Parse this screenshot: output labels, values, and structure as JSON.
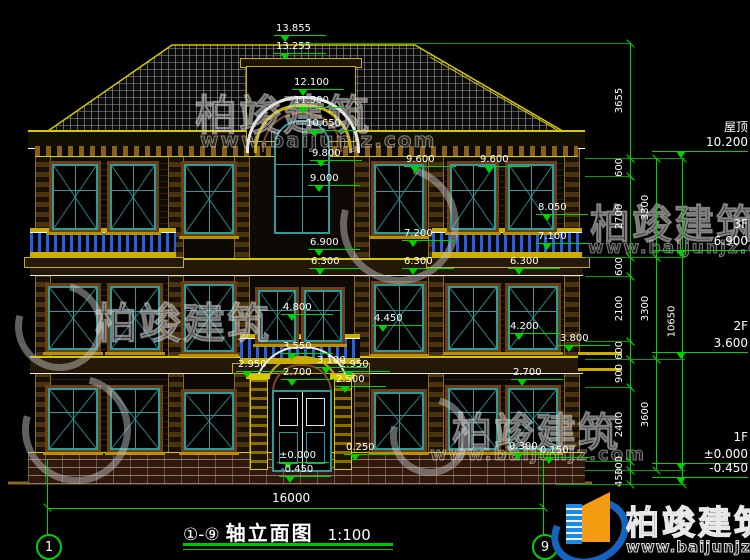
{
  "title_bar": {
    "axes": "①-⑨",
    "name": "轴立面图",
    "scale": "1:100"
  },
  "ground": {
    "total_dim": "16000",
    "axis1": "1",
    "axis9": "9"
  },
  "brand": {
    "name": "柏竣建筑",
    "url": "www.baijunjz.com"
  },
  "colors": {
    "dim_green": "#00d400",
    "trim_yellow": "#d8c800",
    "window_teal": "#2e9a9a",
    "baluster_blue": "#2b5fd9",
    "wall_brown": "#6b3f14",
    "brand_blue": "#1e88e5",
    "brand_orange": "#f39c12"
  },
  "floor_labels": [
    {
      "name": "屋顶",
      "elev": "10.200",
      "y": 158
    },
    {
      "name": "3F",
      "elev": "6.900",
      "y": 257
    },
    {
      "name": "2F",
      "elev": "3.600",
      "y": 359
    },
    {
      "name": "1F",
      "elev": "±0.000",
      "y": 470
    },
    {
      "name": "",
      "elev": "-0.450",
      "y": 484
    }
  ],
  "elevation_markers": [
    {
      "value": "13.855",
      "x": 276,
      "y": 43
    },
    {
      "value": "13.255",
      "x": 276,
      "y": 61
    },
    {
      "value": "12.100",
      "x": 294,
      "y": 97
    },
    {
      "value": "11.500",
      "x": 294,
      "y": 115
    },
    {
      "value": "10.650",
      "x": 306,
      "y": 138
    },
    {
      "value": "9.800",
      "x": 312,
      "y": 168
    },
    {
      "value": "9.600",
      "x": 406,
      "y": 174
    },
    {
      "value": "9.600",
      "x": 480,
      "y": 174
    },
    {
      "value": "9.000",
      "x": 310,
      "y": 193
    },
    {
      "value": "8.050",
      "x": 538,
      "y": 222
    },
    {
      "value": "7.200",
      "x": 404,
      "y": 248
    },
    {
      "value": "7.100",
      "x": 538,
      "y": 251
    },
    {
      "value": "6.900",
      "x": 310,
      "y": 257
    },
    {
      "value": "6.300",
      "x": 311,
      "y": 276
    },
    {
      "value": "6.300",
      "x": 404,
      "y": 276
    },
    {
      "value": "6.300",
      "x": 510,
      "y": 276
    },
    {
      "value": "4.800",
      "x": 283,
      "y": 322
    },
    {
      "value": "4.450",
      "x": 374,
      "y": 333
    },
    {
      "value": "4.200",
      "x": 510,
      "y": 341
    },
    {
      "value": "3.800",
      "x": 560,
      "y": 353
    },
    {
      "value": "3.550",
      "x": 283,
      "y": 361
    },
    {
      "value": "3.100",
      "x": 317,
      "y": 375
    },
    {
      "value": "2.950",
      "x": 238,
      "y": 379
    },
    {
      "value": "2.950",
      "x": 340,
      "y": 379
    },
    {
      "value": "2.700",
      "x": 283,
      "y": 387
    },
    {
      "value": "2.700",
      "x": 513,
      "y": 387
    },
    {
      "value": "2.500",
      "x": 336,
      "y": 394
    },
    {
      "value": "0.250",
      "x": 346,
      "y": 462
    },
    {
      "value": "0.300",
      "x": 509,
      "y": 461
    },
    {
      "value": "0.150",
      "x": 540,
      "y": 465
    },
    {
      "value": "±0.000",
      "x": 279,
      "y": 470
    },
    {
      "value": "-0.450",
      "x": 281,
      "y": 484
    }
  ],
  "dimension_chains": [
    {
      "x": 630,
      "segments": [
        {
          "label": "3655",
          "y1": 43,
          "y2": 158
        },
        {
          "label": "600",
          "y1": 158,
          "y2": 176
        },
        {
          "label": "2700",
          "y1": 176,
          "y2": 257
        },
        {
          "label": "600",
          "y1": 257,
          "y2": 276
        },
        {
          "label": "2100",
          "y1": 276,
          "y2": 341
        },
        {
          "label": "600",
          "y1": 341,
          "y2": 359
        },
        {
          "label": "900",
          "y1": 359,
          "y2": 387
        },
        {
          "label": "2400",
          "y1": 387,
          "y2": 461
        },
        {
          "label": "300",
          "y1": 461,
          "y2": 470
        },
        {
          "label": "450",
          "y1": 470,
          "y2": 484
        }
      ]
    },
    {
      "x": 656,
      "segments": [
        {
          "label": "3300",
          "y1": 158,
          "y2": 257
        },
        {
          "label": "3300",
          "y1": 257,
          "y2": 359
        },
        {
          "label": "3600",
          "y1": 359,
          "y2": 470
        }
      ]
    },
    {
      "x": 682,
      "segments": [
        {
          "label": "10650",
          "y1": 158,
          "y2": 484
        }
      ]
    }
  ],
  "extension_lines": [
    {
      "x": 300,
      "y": 43,
      "w": 330
    },
    {
      "x": 585,
      "y": 158,
      "w": 100
    },
    {
      "x": 585,
      "y": 176,
      "w": 47
    },
    {
      "x": 585,
      "y": 257,
      "w": 100
    },
    {
      "x": 585,
      "y": 276,
      "w": 47
    },
    {
      "x": 585,
      "y": 341,
      "w": 47
    },
    {
      "x": 585,
      "y": 359,
      "w": 100
    },
    {
      "x": 585,
      "y": 387,
      "w": 47
    },
    {
      "x": 585,
      "y": 461,
      "w": 47
    },
    {
      "x": 585,
      "y": 470,
      "w": 100
    },
    {
      "x": 556,
      "y": 484,
      "w": 130
    }
  ],
  "watermarks": [
    {
      "type": "text",
      "text": "柏竣建筑",
      "x": 195,
      "y": 82,
      "size": 42
    },
    {
      "type": "url",
      "text": "www.baijunjz.com",
      "x": 200,
      "y": 128,
      "size": 20
    },
    {
      "type": "logo",
      "x": 340,
      "y": 165,
      "size": 105
    },
    {
      "type": "text",
      "text": "柏竣建筑",
      "x": 590,
      "y": 192,
      "size": 40
    },
    {
      "type": "url",
      "text": "www.baijunjz.com",
      "x": 588,
      "y": 238,
      "size": 17
    },
    {
      "type": "logo",
      "x": 15,
      "y": 282,
      "size": 75
    },
    {
      "type": "text",
      "text": "柏竣建筑",
      "x": 95,
      "y": 290,
      "size": 42
    },
    {
      "type": "logo",
      "x": 22,
      "y": 375,
      "size": 95
    },
    {
      "type": "logo",
      "x": 390,
      "y": 396,
      "size": 66
    },
    {
      "type": "text",
      "text": "柏竣建筑",
      "x": 452,
      "y": 400,
      "size": 40
    },
    {
      "type": "url",
      "text": "www.baijunjz.com",
      "x": 430,
      "y": 444,
      "size": 18
    }
  ]
}
